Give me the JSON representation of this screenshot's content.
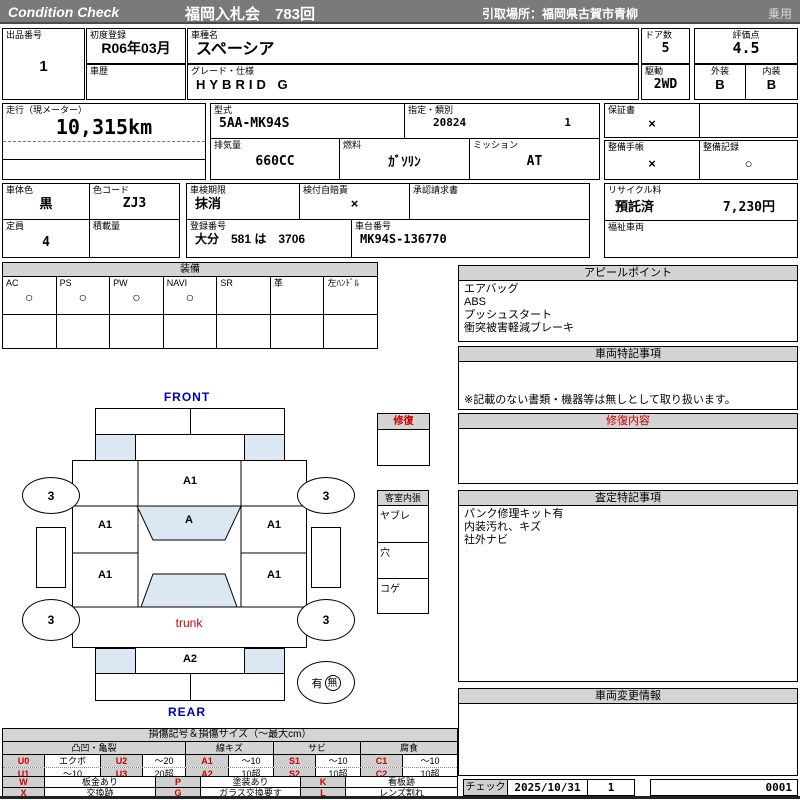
{
  "colors": {
    "header_bar": "#7a7a7a",
    "section_header_bg": "#d4d4d4",
    "diagram_fill": "#dbe7f3",
    "accent_red": "#cc0000",
    "accent_blue": "#0000bb"
  },
  "header": {
    "brand": "Condition  Check",
    "auction": "福岡入札会　783回",
    "pickup": "引取場所：福岡県古賀市青柳",
    "vehicle_class": "乗用"
  },
  "info": {
    "lot_label": "出品番号",
    "lot_value": "1",
    "first_reg_label": "初度登録",
    "first_reg_value": "R06年03月",
    "history_label": "車歴",
    "model_label": "車種名",
    "model_value": "スペーシア",
    "grade_label": "グレード・仕様",
    "grade_value": "HYBRID G",
    "doors_label": "ドア数",
    "doors_value": "5",
    "drive_label": "駆動",
    "drive_value": "2WD",
    "score_label": "評価点",
    "score_value": "4.5",
    "exterior_label": "外装",
    "exterior_value": "B",
    "interior_label": "内装",
    "interior_value": "B",
    "mileage_label": "走行（現メーター）",
    "mileage_value": "10,315km",
    "model_code_label": "型式",
    "model_code_value": "5AA-MK94S",
    "class_label": "指定・類別",
    "class_value1": "20824",
    "class_value2": "1",
    "displacement_label": "排気量",
    "displacement_value": "660CC",
    "fuel_label": "燃料",
    "fuel_value": "ｶﾞｿﾘﾝ",
    "mission_label": "ミッション",
    "mission_value": "AT",
    "warranty_label": "保証書",
    "warranty_value": "×",
    "maint_book_label": "整備手帳",
    "maint_book_value": "×",
    "maint_record_label": "整備記録",
    "maint_record_value": "○",
    "body_color_label": "車体色",
    "body_color_value": "黒",
    "color_code_label": "色コード",
    "color_code_value": "ZJ3",
    "inspection_label": "車検期限",
    "inspection_value": "抹消",
    "insurance_label": "検付自賠責",
    "insurance_value": "×",
    "approval_label": "承認請求書",
    "capacity_label": "定員",
    "capacity_value": "4",
    "load_label": "積載量",
    "reg_no_label": "登録番号",
    "reg_no_value": "大分　581 は　3706",
    "chassis_label": "車台番号",
    "chassis_value": "MK94S-136770",
    "recycle_label": "リサイクル料",
    "recycle_status": "預託済",
    "recycle_fee": "7,230円",
    "welfare_label": "福祉車両"
  },
  "equipment": {
    "title": "装備",
    "items": [
      {
        "label": "AC",
        "mark": "○"
      },
      {
        "label": "PS",
        "mark": "○"
      },
      {
        "label": "PW",
        "mark": "○"
      },
      {
        "label": "NAVI",
        "mark": "○"
      },
      {
        "label": "SR",
        "mark": ""
      },
      {
        "label": "革",
        "mark": ""
      },
      {
        "label": "左ﾊﾝﾄﾞﾙ",
        "mark": ""
      }
    ]
  },
  "appeal": {
    "title": "アピールポイント",
    "lines": [
      "エアバッグ",
      "ABS",
      "プッシュスタート",
      "衝突被害軽減ブレーキ"
    ]
  },
  "special_notes": {
    "title": "車両特記事項",
    "note": "※記載のない書類・機器等は無しとして取り扱います。"
  },
  "repair_content": {
    "title": "修復内容"
  },
  "assessment_notes": {
    "title": "査定特記事項",
    "lines": [
      "パンク修理キット有",
      "内装汚れ、キズ",
      "社外ナビ"
    ]
  },
  "change_info": {
    "title": "車両変更情報"
  },
  "check": {
    "label": "チェック",
    "date": "2025/10/31",
    "count": "1",
    "serial": "0001"
  },
  "diagram": {
    "front_label": "FRONT",
    "rear_label": "REAR",
    "trunk_label": "trunk",
    "windshield_mark": "A1",
    "roof_mark": "A",
    "left_front_mark": "A1",
    "right_front_mark": "A1",
    "left_rear_mark": "A1",
    "right_rear_mark": "A1",
    "rear_panel_mark": "A2",
    "wheels": [
      "3",
      "3",
      "3",
      "3"
    ],
    "repair_title": "修復",
    "interior_title": "客室内張",
    "interior_rows": [
      "ヤブレ",
      "穴",
      "コゲ"
    ],
    "spare_yes": "有",
    "spare_no": "無"
  },
  "legend": {
    "title": "損傷記号＆損傷サイズ（〜最大cm）",
    "headers": [
      "凸凹・亀裂",
      "線キズ",
      "サビ",
      "腐食"
    ],
    "row1": [
      "U0",
      "エクボ",
      "U2",
      "〜20",
      "A1",
      "〜10",
      "S1",
      "〜10",
      "C1",
      "〜10"
    ],
    "row2": [
      "U1",
      "〜10",
      "U3",
      "20超",
      "A2",
      "10超",
      "S2",
      "10超",
      "C2",
      "10超"
    ],
    "row3": [
      "W",
      "板金あり",
      "P",
      "塗装あり",
      "K",
      "看板跡"
    ],
    "row4": [
      "X",
      "交換跡",
      "G",
      "ガラス交換要す",
      "L",
      "レンズ割れ"
    ]
  }
}
